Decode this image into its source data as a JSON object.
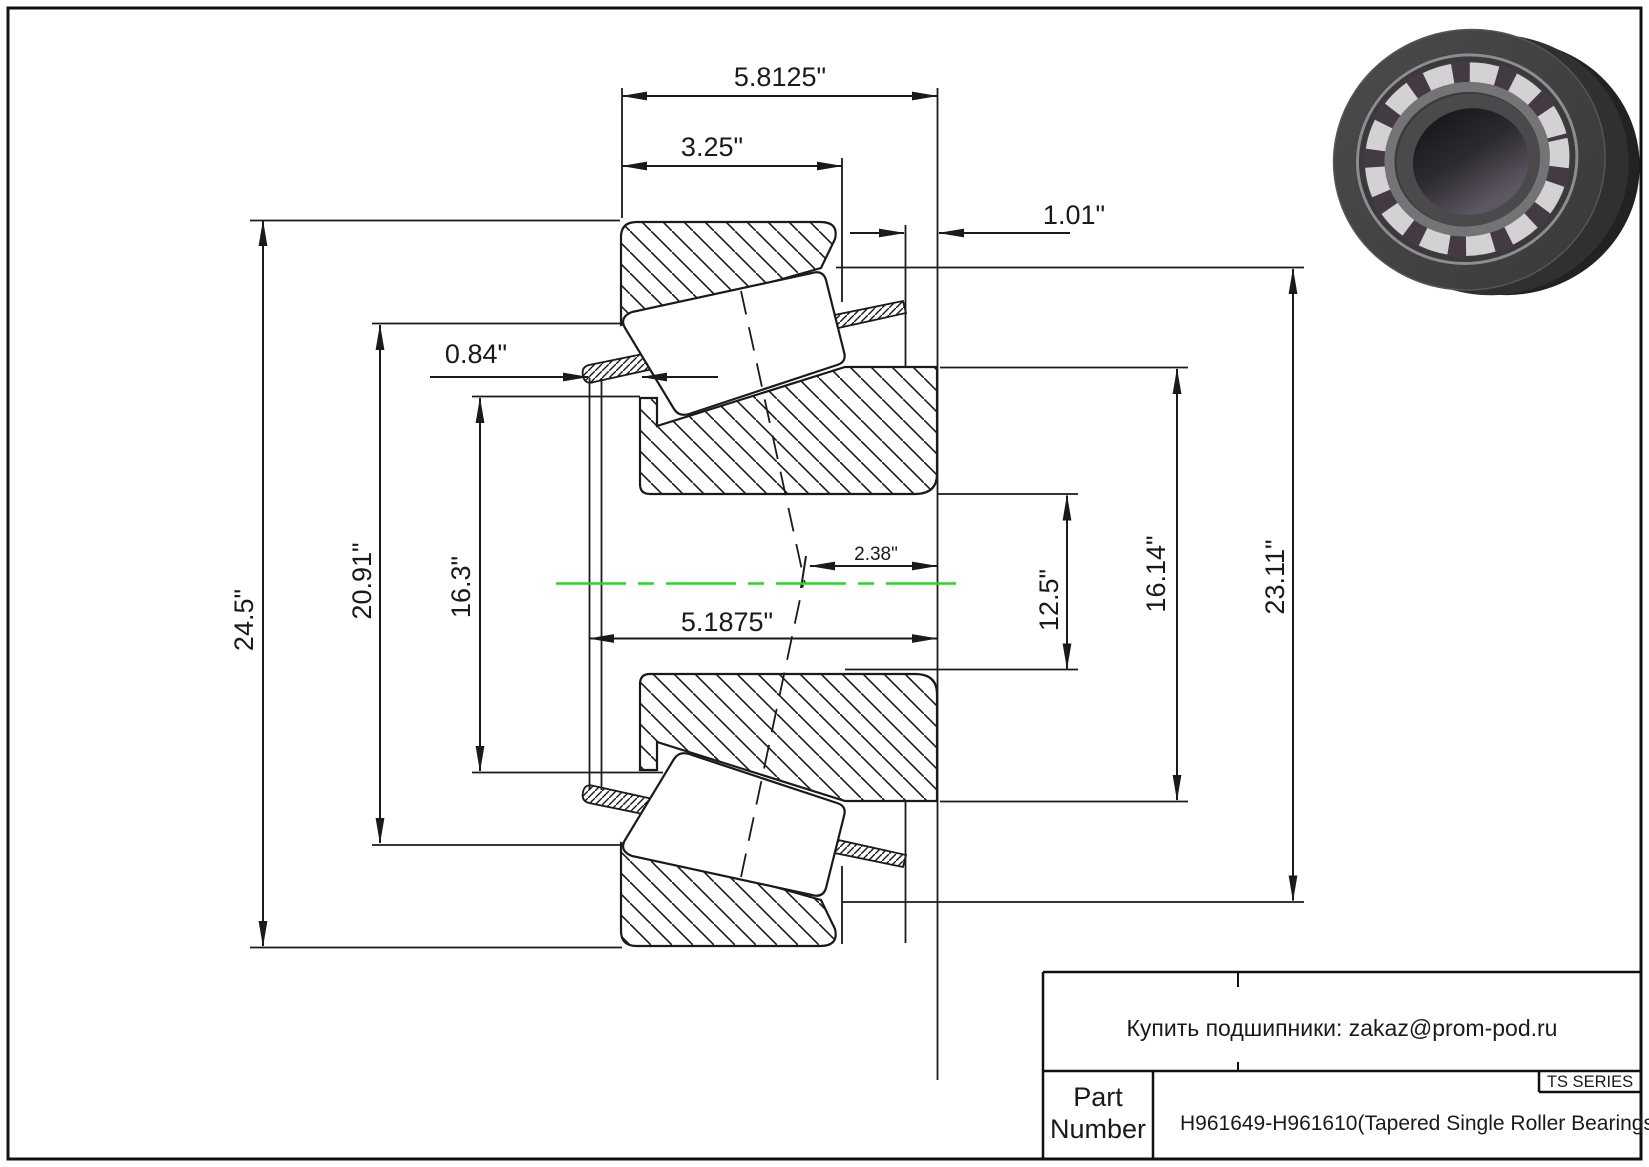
{
  "drawing": {
    "type": "tapered-single-roller-bearing-cross-section",
    "dims": {
      "overall_width": "5.8125\"",
      "cup_width": "3.25\"",
      "back_offset": "1.01\"",
      "cage_offset": "0.84\"",
      "outer_diameter": "24.5\"",
      "race_diameter": "20.91\"",
      "rib_diameter": "16.3\"",
      "apex_offset": "2.38\"",
      "cone_width": "5.1875\"",
      "bore_diameter": "12.5\"",
      "back_face_diameter": "16.14\"",
      "flange_diameter": "23.11\""
    },
    "centerline_color": "#1ddd1d",
    "line_color": "#1a1a1a"
  },
  "title_block": {
    "supplier_note": "Купить подшипники: zakaz@prom-pod.ru",
    "series_label": "TS SERIES",
    "part_label_line1": "Part",
    "part_label_line2": "Number",
    "part_number": "H961649-H961610(Tapered Single Roller Bearings)"
  }
}
